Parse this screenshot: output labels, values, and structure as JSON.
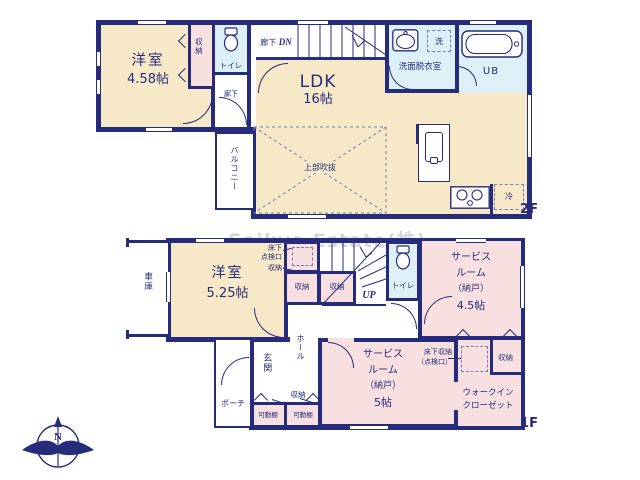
{
  "watermark": "Saikyo Estate(株)",
  "compass": {
    "north": "N"
  },
  "colors": {
    "wall": "#262b7c",
    "room": "#f7e9c8",
    "storage": "#f8dfe0",
    "wet": "#def0f7"
  },
  "floor2": {
    "floor_label": "2F",
    "western_room": {
      "name": "洋室",
      "size": "4.58帖"
    },
    "closet": "収納",
    "toilet": "トイレ",
    "corridor_small": "廊下",
    "corridor": "廊下",
    "down": "DN",
    "ldk": {
      "name": "LDK",
      "size": "16帖"
    },
    "washroom": "洗面脱衣室",
    "washer": "洗",
    "bath": "UB",
    "void": "上部吹抜",
    "fridge": "冷",
    "balcony": "バルコニー"
  },
  "floor1": {
    "floor_label": "1F",
    "garage": "車庫",
    "western_room": {
      "name": "洋室",
      "size": "5.25帖"
    },
    "hatch": {
      "line1": "床下",
      "line2": "点検口"
    },
    "hatch_closet": "収納",
    "closet_left": "収納",
    "closet_right": "収納",
    "up": "UP",
    "toilet": "トイレ",
    "service_a": {
      "line1": "サービス",
      "line2": "ルーム",
      "line3": "（納戸）",
      "line4": "4.5帖"
    },
    "hall": "ホール",
    "entrance": "玄関",
    "porch": "ポーチ",
    "shelf_closet": "収納",
    "shelf_left": "可動棚",
    "shelf_right": "可動棚",
    "service_b": {
      "line1": "サービス",
      "line2": "ルーム",
      "line3": "（納戸）",
      "line4": "5帖"
    },
    "underfloor": {
      "line1": "床下収納",
      "line2": "（点検口）"
    },
    "wic_closet": "収納",
    "wic": {
      "line1": "ウォークイン",
      "line2": "クローゼット"
    }
  }
}
